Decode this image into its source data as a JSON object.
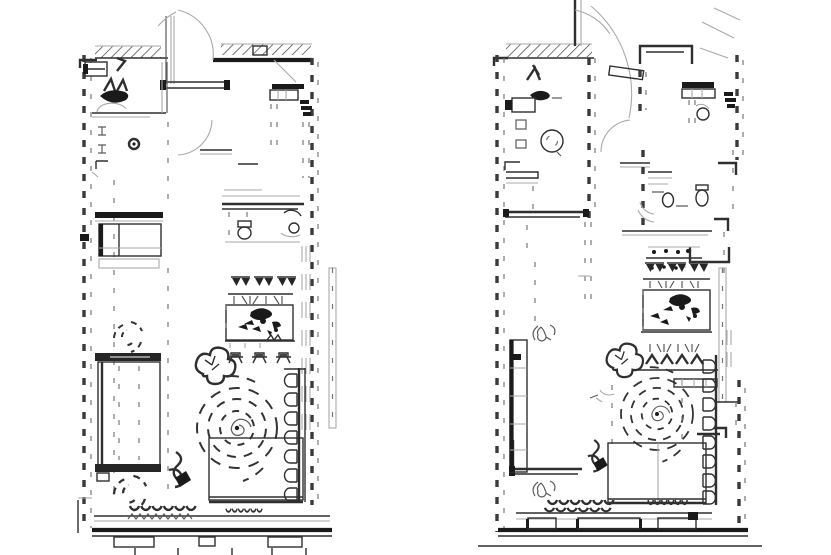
{
  "meta": {
    "colors": {
      "bg": "#ffffff",
      "ink": "#2f2f2f",
      "ink-dark": "#1a1a1a",
      "ink-mid": "#5a5a5a",
      "ink-faint": "#a9a9a9",
      "wall-dash": "#3a3a3a"
    }
  },
  "drawing": {
    "title": "Two hand-drafted apartment floor plan variants drawn side by side in black ink on white",
    "plans": [
      {
        "id": "left-plan",
        "aria": "Left floor plan variant",
        "features": [
          "hatched exterior wall band",
          "dashed cavity walls",
          "entry door swing arc",
          "bathroom with dark basin sketch and mat",
          "door jambs with pivot knob",
          "hall cabinet with dark shelf",
          "bedroom dresser with dark rail",
          "en-suite toilet and round basin",
          "dining table with three chair backs, centerpiece sketch and three stools",
          "double bed with dashed mattress lines",
          "round dashed area rug with spiral center",
          "two dashed potted plants",
          "dark lamp scribble",
          "cushioned sofa on right wall",
          "TV sideboard rectangle",
          "scalloped window sills and bottom wall stubs",
          "service shaft band outside right wall"
        ]
      },
      {
        "id": "right-plan",
        "aria": "Right floor plan variant",
        "features": [
          "hatched exterior wall band",
          "dashed cavity walls",
          "entry door swing arc with hatched door leaf",
          "bathroom with dark console, squiggle plant and washing machine drum",
          "kitchen counter with round sink and dark worktop",
          "second bathroom with WC pair and shower curves",
          "sideboard with jar dots",
          "dining table with chair backs, centerpiece sketch and zigzag chair row",
          "tall wardrobe with dark edge",
          "round dashed area rug crossed by dashed lines",
          "potted plant scribble",
          "cushioned sofa with hatched bench",
          "TV sideboard rectangle",
          "three hatched radiators under window",
          "scalloped window sills",
          "two handwritten bracket-six marks",
          "dark lamp scribble"
        ]
      }
    ]
  }
}
